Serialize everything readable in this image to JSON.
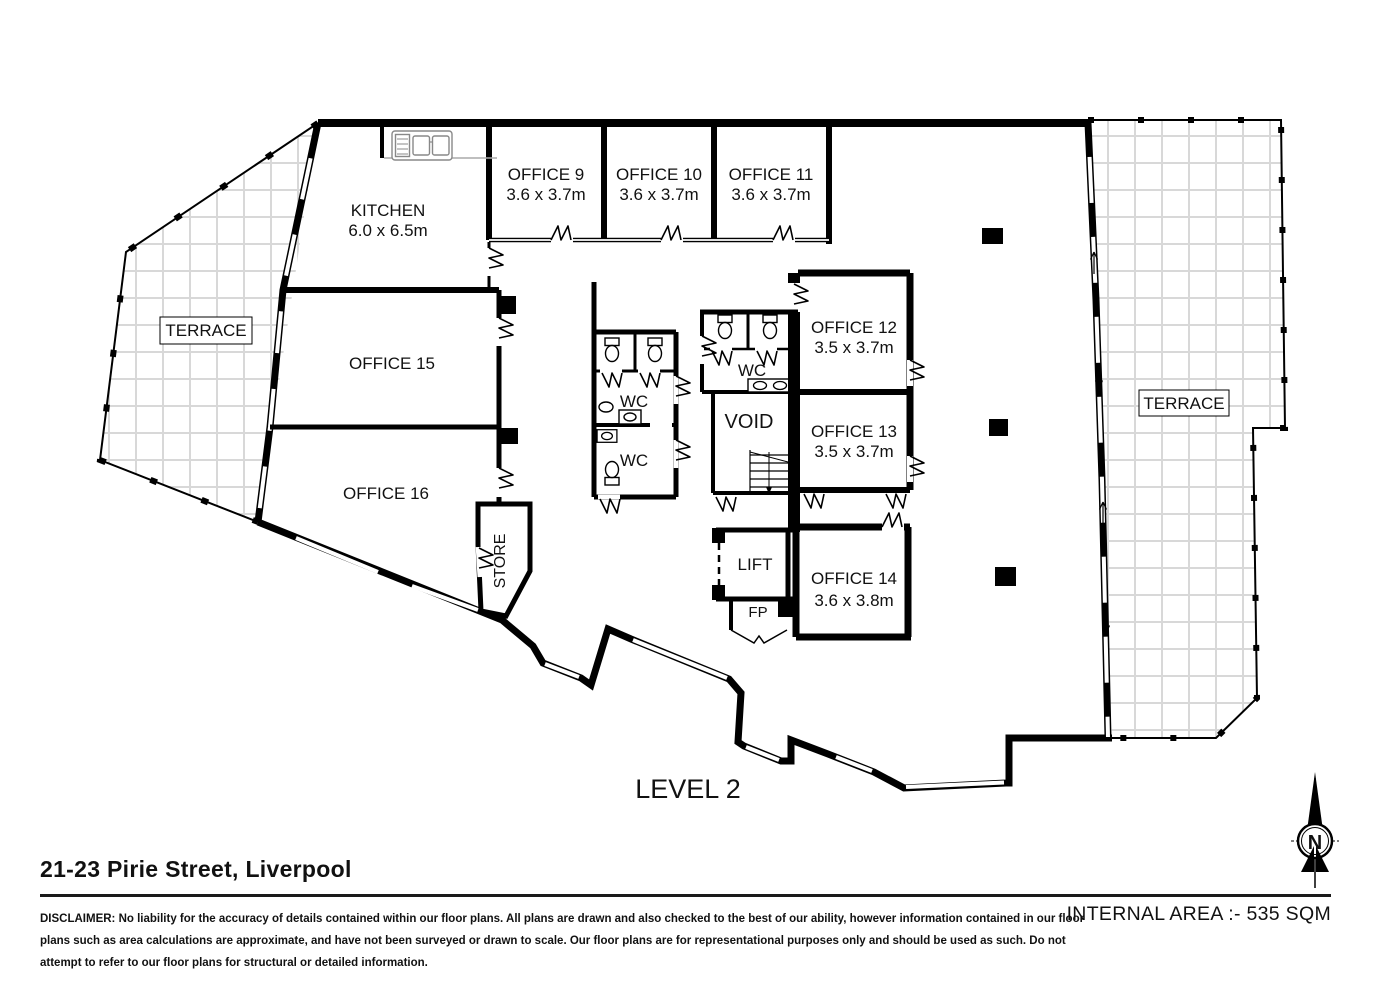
{
  "plan": {
    "level_label": "LEVEL 2",
    "compass_label": "N",
    "rooms": {
      "kitchen": {
        "name": "KITCHEN",
        "dims": "6.0 x 6.5m"
      },
      "office9": {
        "name": "OFFICE 9",
        "dims": "3.6 x 3.7m"
      },
      "office10": {
        "name": "OFFICE 10",
        "dims": "3.6 x 3.7m"
      },
      "office11": {
        "name": "OFFICE 11",
        "dims": "3.6 x 3.7m"
      },
      "office12": {
        "name": "OFFICE 12",
        "dims": "3.5 x 3.7m"
      },
      "office13": {
        "name": "OFFICE 13",
        "dims": "3.5 x 3.7m"
      },
      "office14": {
        "name": "OFFICE 14",
        "dims": "3.6 x 3.8m"
      },
      "office15": {
        "name": "OFFICE 15"
      },
      "office16": {
        "name": "OFFICE 16"
      },
      "terrace_left": {
        "name": "TERRACE"
      },
      "terrace_right": {
        "name": "TERRACE"
      },
      "store": {
        "name": "STORE"
      },
      "lift": {
        "name": "LIFT"
      },
      "fp": {
        "name": "FP"
      },
      "void": {
        "name": "VOID"
      },
      "wc_left_upper": {
        "name": "WC"
      },
      "wc_left_lower": {
        "name": "WC"
      },
      "wc_center": {
        "name": "WC"
      }
    }
  },
  "footer": {
    "address": "21-23 Pirie Street, Liverpool",
    "internal_area": "INTERNAL AREA :- 535 SQM",
    "disclaimer_lines": [
      "DISCLAIMER: No liability for the accuracy of details contained within our floor plans. All plans are drawn and also checked to the best of our ability, however information contained in our floor",
      "plans such as area calculations are approximate, and have not been surveyed or drawn to scale. Our floor plans are for representational purposes only and should be used as such. Do not",
      "attempt to refer to our floor plans for structural or detailed information."
    ]
  },
  "colors": {
    "wall": "#000000",
    "background": "#ffffff",
    "terrace_grid": "#d8d8d8",
    "counter_line": "#aaaaaa"
  }
}
